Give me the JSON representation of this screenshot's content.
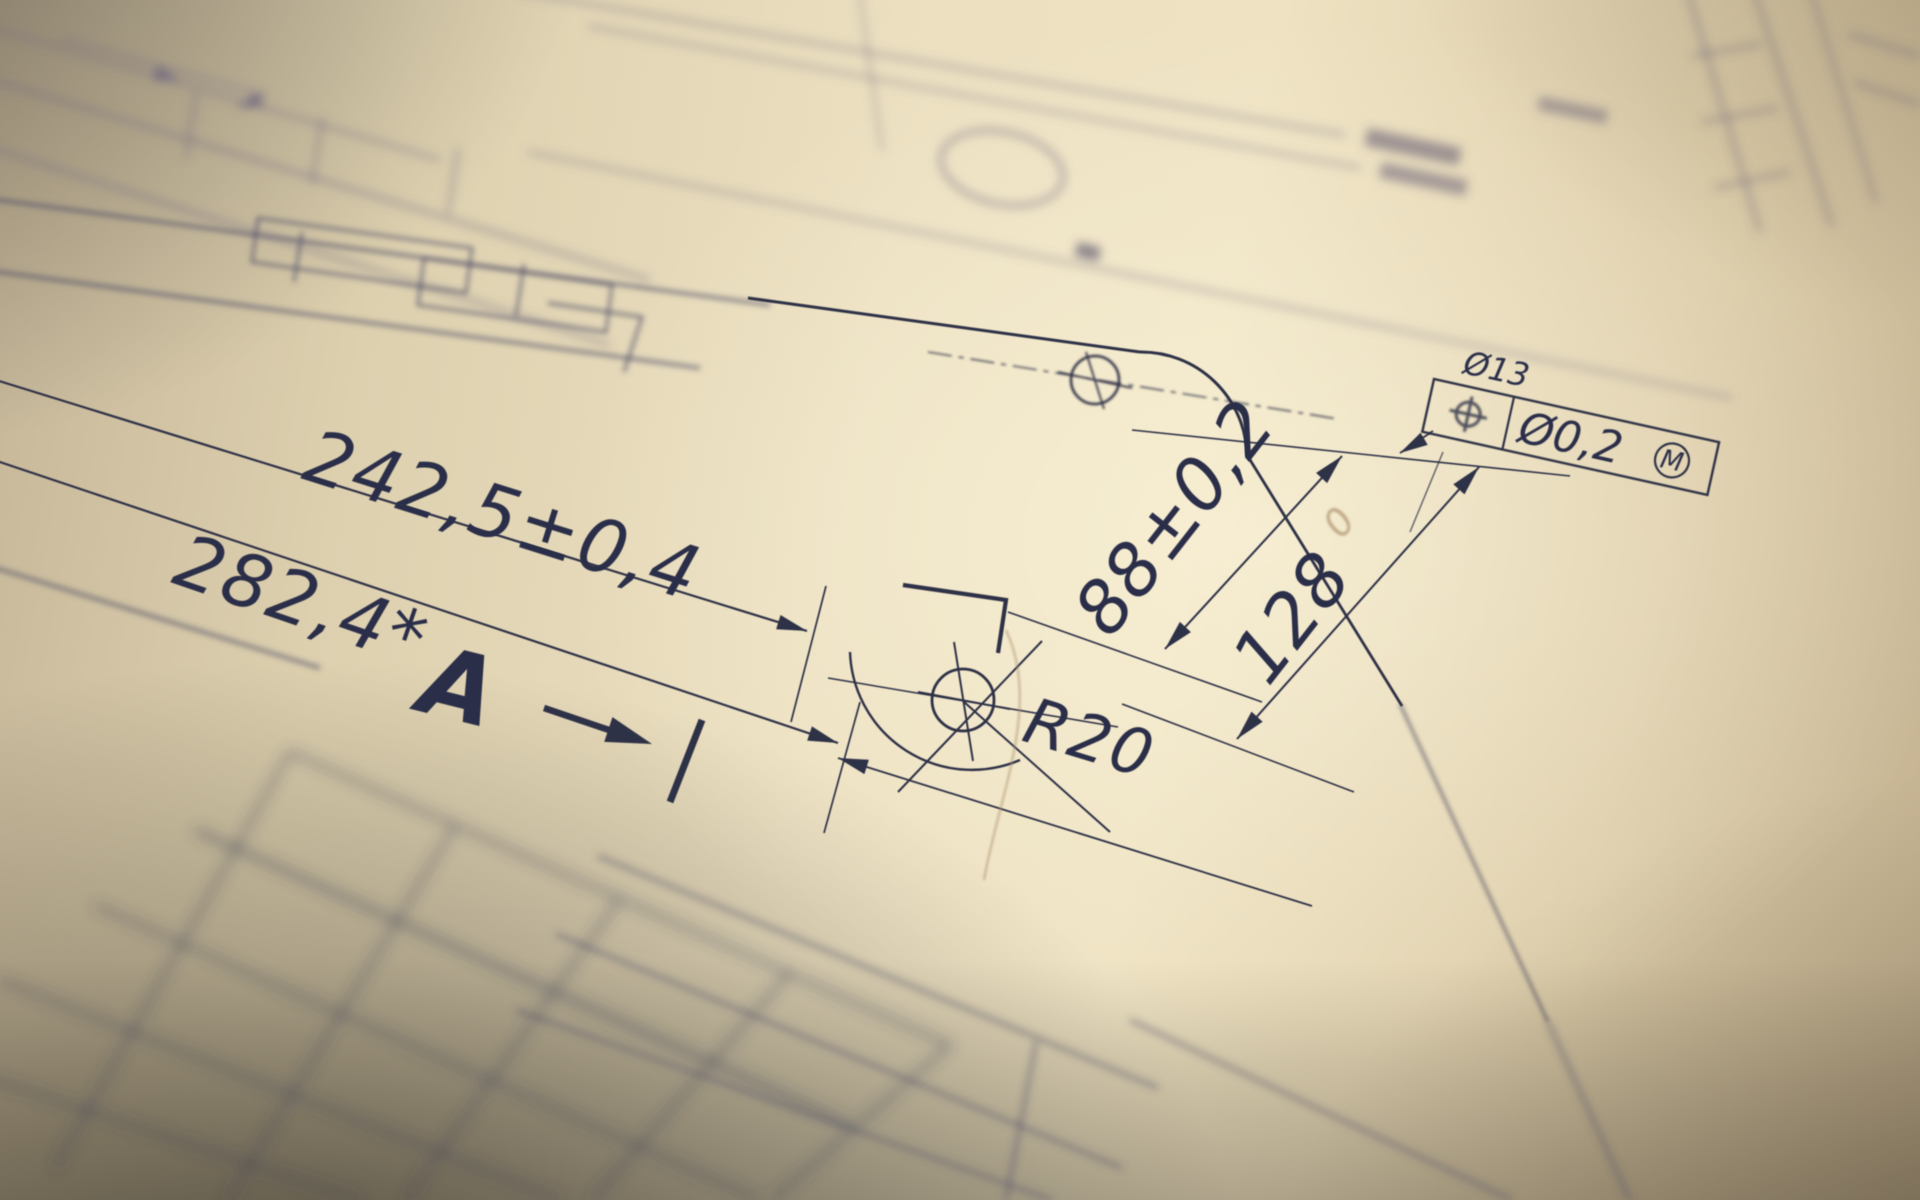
{
  "drawing": {
    "dimensions": {
      "length_outer": "282,4*",
      "length_inner": "242,5±0,4",
      "height_hole": "88±0,2",
      "height_edge": "128",
      "corner_radius": "R20"
    },
    "section_label": "A",
    "feature_control_frame": {
      "hole_callout": "Ø13",
      "geometric_symbol": "position-tolerance",
      "tolerance_value": "Ø0,2",
      "material_modifier": "M"
    },
    "pencil_note": "0"
  },
  "colors": {
    "paper_light": "#eee2c2",
    "paper_shadow": "#c2b08f",
    "ink": "#2d3047",
    "blurred_ink": "#6f6880",
    "pencil": "#b39a74"
  }
}
